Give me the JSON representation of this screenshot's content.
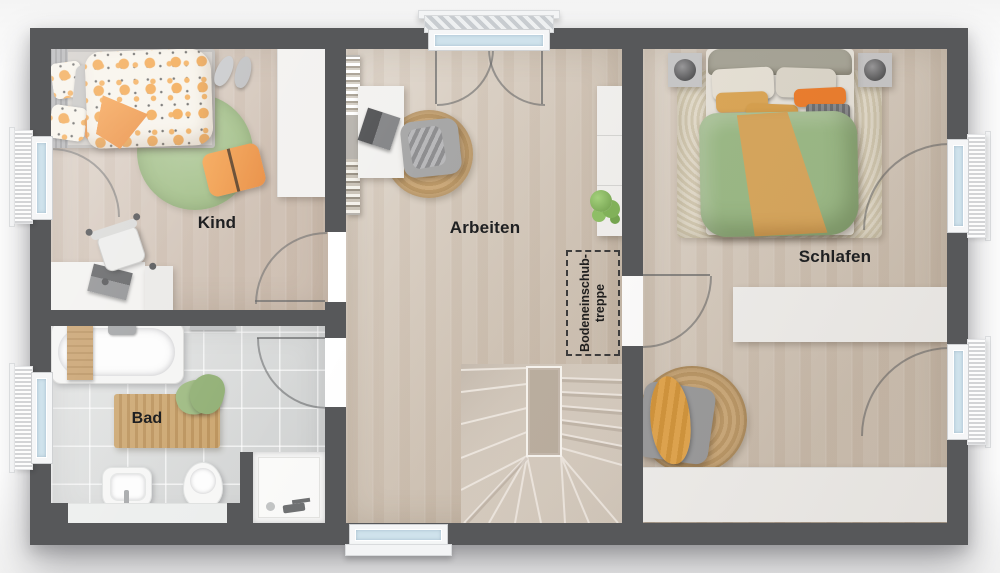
{
  "rooms": {
    "kind": {
      "label": "Kind"
    },
    "arbeiten": {
      "label": "Arbeiten"
    },
    "schlafen": {
      "label": "Schlafen"
    },
    "bad": {
      "label": "Bad"
    },
    "attic_hatch": {
      "line1": "Bodeneinschub-",
      "line2": "treppe"
    }
  },
  "colors": {
    "wall": "#57585a",
    "wood_floor": "#d8cdc0",
    "wood_floor_kind": "#d6c8bc",
    "tile_floor": "#d9dbda",
    "glass": "#cfe2ec",
    "frame_white": "#f5f6f7",
    "furniture_white": "#f2f1ef",
    "accent_orange": "#ef913c",
    "accent_green": "#9cbb88",
    "rug_green": "#a0bd85",
    "jute": "#c8a674",
    "label_text": "#1f2022"
  }
}
